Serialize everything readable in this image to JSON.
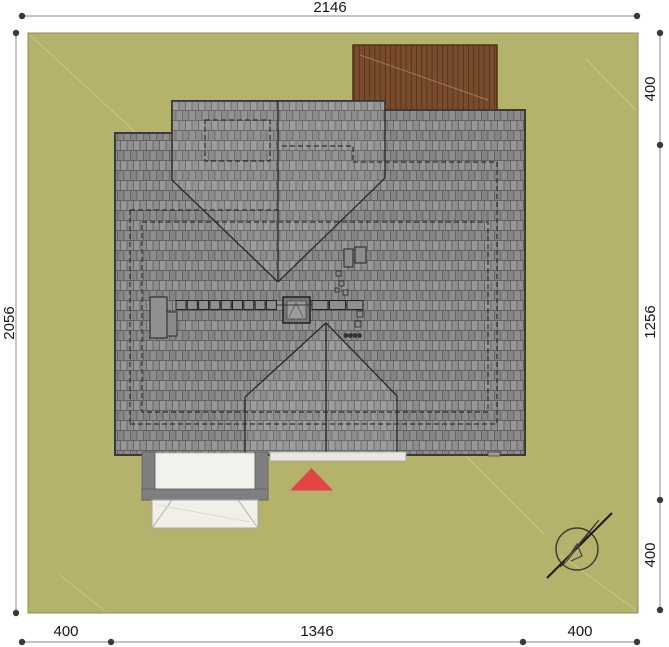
{
  "meta": {
    "type": "architectural-site-plan",
    "view": "roof-plan-top-view"
  },
  "dimensions": {
    "top": {
      "label": "2146"
    },
    "left": {
      "label": "2056"
    },
    "right": {
      "labels": [
        "400",
        "1256",
        "400"
      ]
    },
    "bottom": {
      "labels": [
        "400",
        "1346",
        "400"
      ]
    }
  },
  "colors": {
    "paper": "#ffffff",
    "site": "#b5b26b",
    "site_border": "#8f8d50",
    "roof": "#8e8e8e",
    "roof_edge": "#3a3a3a",
    "deck": "#7a4c2b",
    "entrance_marker": "#e34444",
    "dimension_text": "#161616"
  },
  "elements": {
    "site": "plot",
    "main_roof": "tiled hip roof",
    "upper_gable": "cross gable north",
    "lower_gable": "cross gable south",
    "deck": "wooden terrace",
    "chimney": "chimney",
    "skylight": "roof window",
    "roof_walkway": "snow guard row",
    "porch": "entrance porch with steps",
    "walkway": "entrance path",
    "entrance_marker": "entrance arrow",
    "north_arrow": "compass"
  }
}
